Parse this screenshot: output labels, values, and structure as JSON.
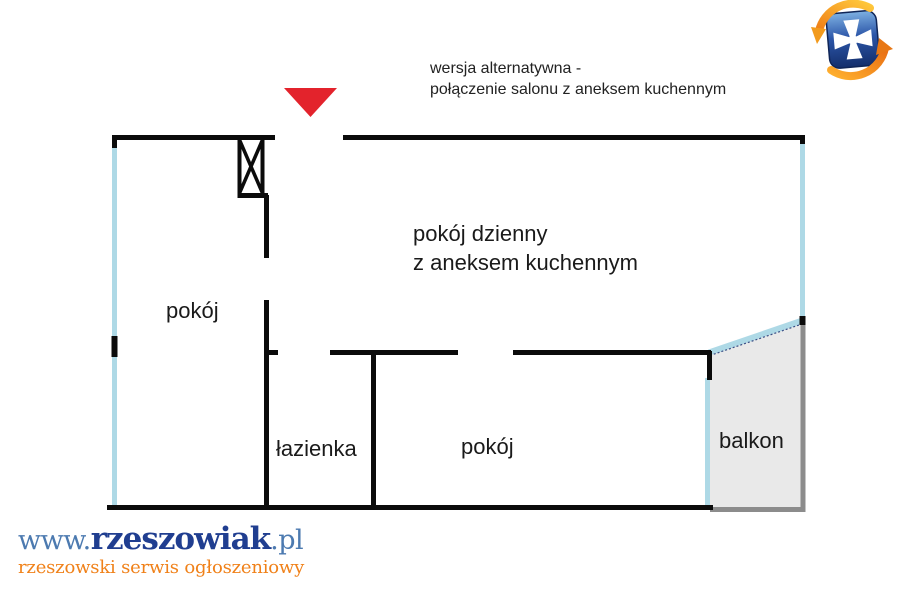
{
  "annotation": {
    "line1": "wersja alternatywna -",
    "line2": "połączenie salonu z aneksem kuchennym"
  },
  "rooms": {
    "living_line1": "pokój dzienny",
    "living_line2": "z aneksem kuchennym",
    "room_left": "pokój",
    "bathroom": "łazienka",
    "room_bottom": "pokój",
    "balcony": "balkon"
  },
  "branding": {
    "www": "www.",
    "name": "rzeszowiak",
    "tld": ".pl",
    "tagline": "rzeszowski serwis ogłoszeniowy"
  },
  "icons": {
    "entrance_marker": "red-down-triangle",
    "logo": "rzeszow-crest-with-orange-swirl-arrows",
    "shaft_symbol": "crossed-box-ventilation-shaft"
  },
  "colors": {
    "wall": "#0b0b0b",
    "window_blue": "#aed9e6",
    "balcony_fill": "#e9e9e9",
    "balcony_rail": "#8c8c8c",
    "entrance_red": "#e3232c",
    "brand_navy": "#203e90",
    "brand_blue": "#4c7ab0",
    "brand_orange": "#f08119"
  }
}
